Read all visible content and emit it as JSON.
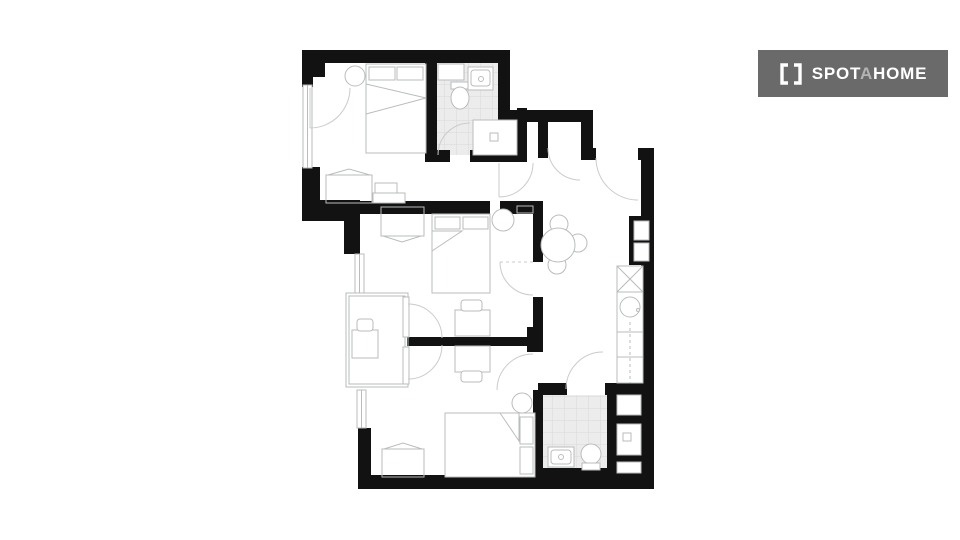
{
  "theme": {
    "page_bg": "#ffffff",
    "wall": "#121212",
    "furniture_line": "#b9bcbe",
    "door_line": "#c8cbcd",
    "tile_fill": "#ececec",
    "tile_line": "#d9d9d9",
    "logo_bg": "#6a6a6a",
    "logo_fg": "#ffffff",
    "logo_accent": "#b3b3b3"
  },
  "logo": {
    "brand": "Spotahome",
    "icon": "brackets-icon",
    "part1": "SPOT",
    "accent": "A",
    "part2": "HOME"
  },
  "floorplan": {
    "type": "apartment-floor-plan",
    "rooms": [
      {
        "id": "bedroom-1",
        "area": "top-left",
        "fixtures": [
          "double-bed",
          "round-side-table",
          "wardrobe",
          "dresser",
          "casement-window"
        ]
      },
      {
        "id": "bathroom-1",
        "area": "top",
        "fixtures": [
          "toilet",
          "washbasin",
          "shower-tray",
          "tiled-floor",
          "cistern-box",
          "door"
        ]
      },
      {
        "id": "entry-hall",
        "area": "top-right",
        "fixtures": [
          "entrance-door",
          "closet-niche",
          "hall-door"
        ]
      },
      {
        "id": "bedroom-2",
        "area": "middle",
        "fixtures": [
          "double-bed",
          "wardrobe",
          "desk",
          "chair",
          "washbasin",
          "radiator",
          "french-door-to-balcony",
          "door"
        ]
      },
      {
        "id": "living-dining",
        "area": "center-right",
        "fixtures": [
          "round-dining-table",
          "chairs"
        ]
      },
      {
        "id": "kitchen",
        "area": "right-strip",
        "fixtures": [
          "hob",
          "sink",
          "counter",
          "cabinets",
          "service-shaft"
        ]
      },
      {
        "id": "balcony",
        "area": "left",
        "fixtures": [
          "bistro-table",
          "chair",
          "french-doors",
          "railing"
        ]
      },
      {
        "id": "bedroom-3",
        "area": "bottom",
        "fixtures": [
          "double-bed",
          "round-side-table",
          "wardrobe",
          "desk",
          "chair",
          "french-door-to-balcony",
          "door"
        ]
      },
      {
        "id": "bathroom-2",
        "area": "bottom-right",
        "fixtures": [
          "toilet",
          "washbasin",
          "shower-tray",
          "storage-niche",
          "tiled-floor",
          "door"
        ]
      }
    ]
  }
}
